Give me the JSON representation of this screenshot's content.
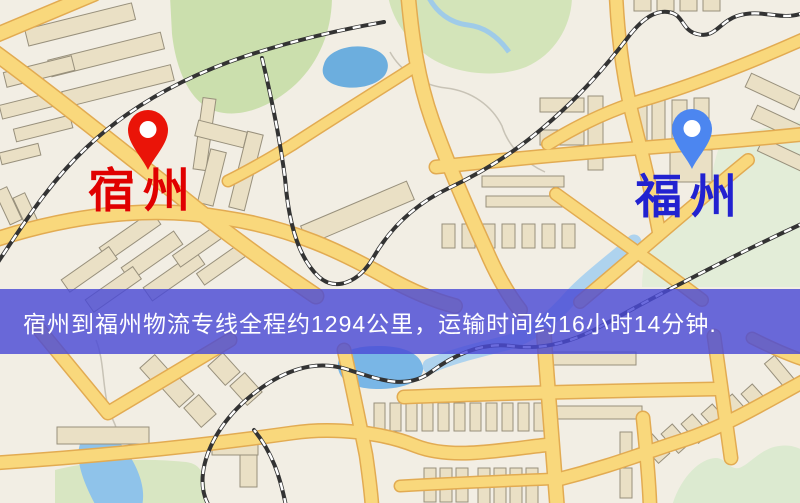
{
  "banner": {
    "text": "宿州到福州物流专线全程约1294公里，运输时间约16小时14分钟.",
    "bg_color": "#4a4ad6",
    "text_color": "#ffffff"
  },
  "origin": {
    "label": "宿州",
    "label_color": "#e00000",
    "pin_color": "#ea1408"
  },
  "destination": {
    "label": "福州",
    "label_color": "#2222d0",
    "pin_color": "#4c86f0"
  },
  "route": {
    "distance_text": "全程约1294公里",
    "duration_text": "运输时间约16小时14分钟"
  },
  "map_colors": {
    "background": "#f2eee4",
    "road_fill": "#f9d87c",
    "road_casing": "#e2ab52",
    "railway": "#333333",
    "water": "#79b6e6",
    "park": "#cfe0ad",
    "building": "#eae0c5"
  }
}
